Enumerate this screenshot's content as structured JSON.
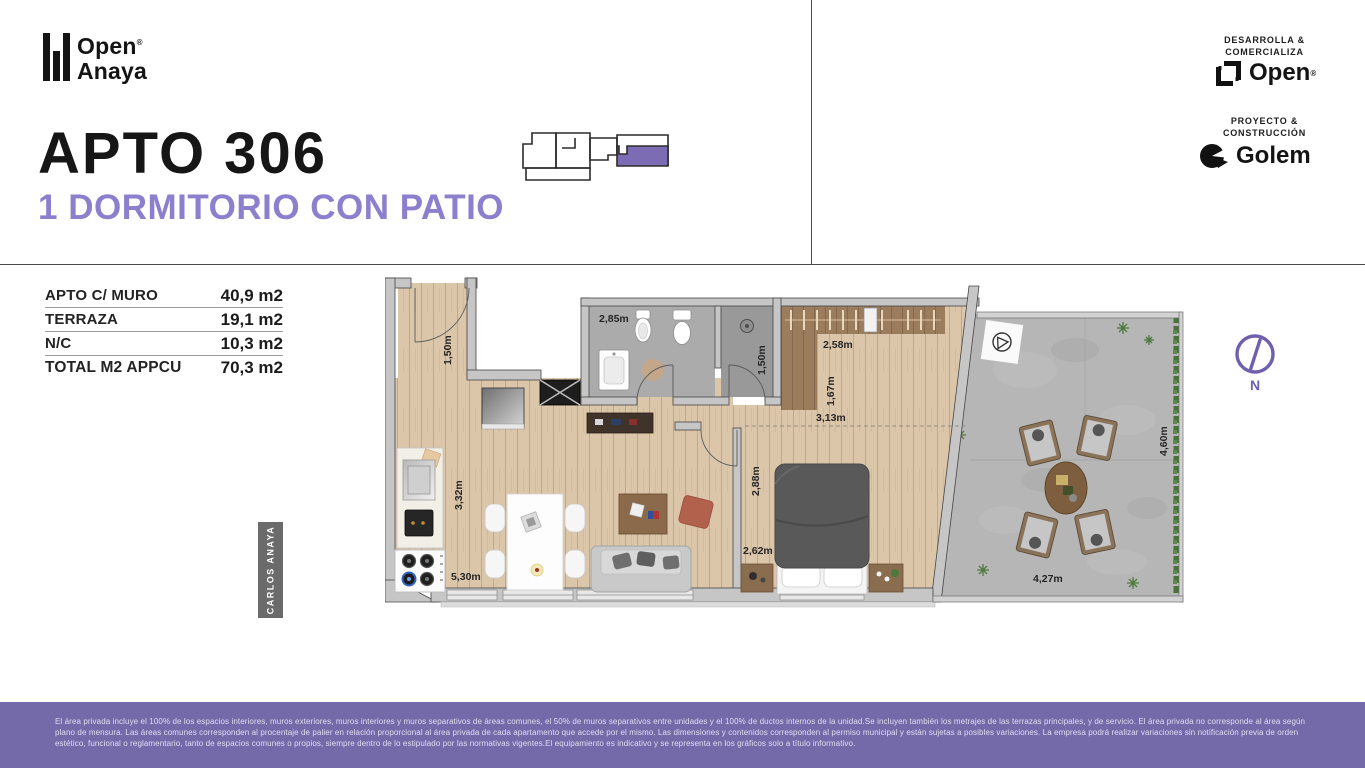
{
  "brand": {
    "word1": "Open",
    "word2": "Anaya",
    "registered": "®"
  },
  "header": {
    "title": "APTO 306",
    "subtitle": "1 DORMITORIO CON PATIO"
  },
  "partners": {
    "developer_role_1": "DESARROLLA &",
    "developer_role_2": "COMERCIALIZA",
    "developer_name": "Open",
    "developer_reg": "®",
    "builder_role_1": "PROYECTO &",
    "builder_role_2": "CONSTRUCCIÓN",
    "builder_name": "Golem"
  },
  "areas": {
    "rows": [
      {
        "label": "APTO C/ MURO",
        "value": "40,9 m2"
      },
      {
        "label": "TERRAZA",
        "value": "19,1 m2"
      },
      {
        "label": "N/C",
        "value": "10,3 m2"
      },
      {
        "label": "TOTAL M2 APPCU",
        "value": "70,3 m2"
      }
    ]
  },
  "plan": {
    "street_label": "CARLOS ANAYA",
    "north_label": "N",
    "dims": {
      "entry": "1,50m",
      "bath": "2,85m",
      "shower": "1,50m",
      "closet_width": "2,58m",
      "closet_depth": "1,67m",
      "bedroom_width": "3,13m",
      "bedroom_depth": "2,88m",
      "bedroom_side": "2,62m",
      "kitchen_depth": "3,32m",
      "living_width": "5,30m",
      "patio_depth": "4,60m",
      "patio_width": "4,27m"
    }
  },
  "footer": {
    "legal": "El área privada incluye el 100% de los espacios interiores, muros exteriores, muros interiores y muros separativos de áreas comunes, el 50% de muros separativos entre unidades y el 100% de ductos internos de la unidad.Se incluyen también los metrajes de las terrazas principales, y de servicio. El área privada no corresponde al área según plano de mensura. Las áreas comunes corresponden al procentaje de palier en relación proporcional al área privada de cada apartamento que accede por el mismo. Las dimensiones y contenidos corresponden al permiso municipal y están sujetas a posibles variaciones. La empresa podrá realizar variaciones sin notificación previa de orden estético, funcional o reglamentario, tanto de espacios comunes o propios, siempre dentro de lo estipulado por las normativas vigentes.El equipamiento es indicativo y se representa en los gráficos solo a título informativo."
  },
  "colors": {
    "accent_purple": "#8b7fce",
    "keyplan_purple": "#7b6cb4",
    "footer_purple": "#746aa9",
    "compass_purple": "#6f5fae",
    "wall_gray": "#c6c6c6",
    "wood": "#dcc6aa",
    "bath_tile": "#ababab",
    "patio_concrete": "#b6b6b6"
  }
}
